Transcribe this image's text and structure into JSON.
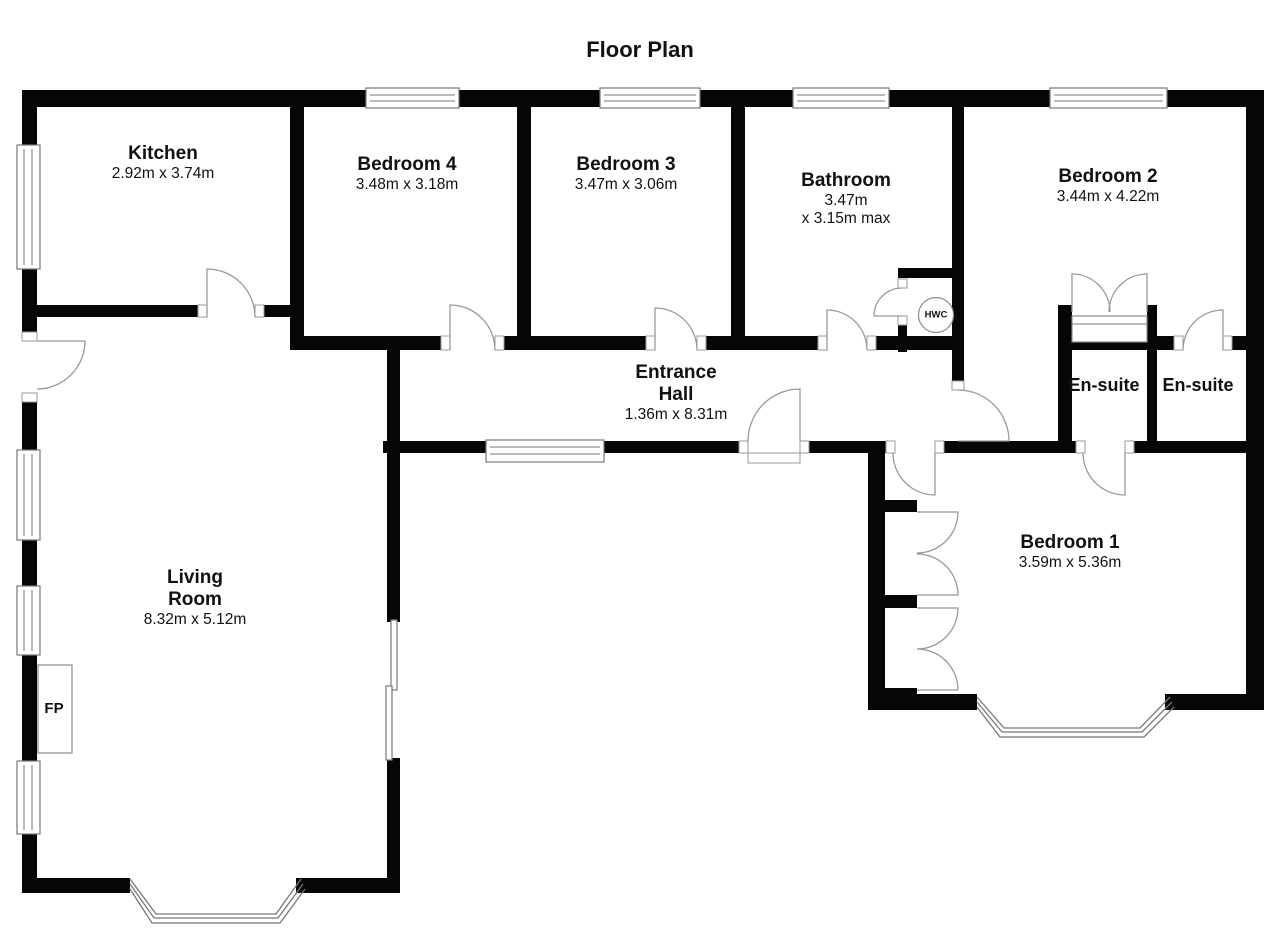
{
  "title": "Floor Plan",
  "rooms": {
    "kitchen": {
      "name": "Kitchen",
      "dims": "2.92m x 3.74m"
    },
    "bedroom4": {
      "name": "Bedroom 4",
      "dims": "3.48m x 3.18m"
    },
    "bedroom3": {
      "name": "Bedroom 3",
      "dims": "3.47m x 3.06m"
    },
    "bathroom": {
      "name": "Bathroom",
      "dims": "3.47m",
      "dims2": "x 3.15m max"
    },
    "bedroom2": {
      "name": "Bedroom 2",
      "dims": "3.44m x 4.22m"
    },
    "entrance_hall": {
      "name_line1": "Entrance",
      "name_line2": "Hall",
      "dims": "1.36m x 8.31m"
    },
    "ensuite_left": {
      "name": "En-suite"
    },
    "ensuite_right": {
      "name": "En-suite"
    },
    "living_room": {
      "name_line1": "Living",
      "name_line2": "Room",
      "dims": "8.32m x 5.12m"
    },
    "bedroom1": {
      "name": "Bedroom 1",
      "dims": "3.59m x 5.36m"
    }
  },
  "markers": {
    "fireplace": "FP",
    "hot_water_cylinder": "HWC"
  },
  "colors": {
    "wall": "#060606",
    "door_line": "#999999",
    "window_line": "#777777",
    "text": "#111111",
    "background": "#ffffff"
  }
}
